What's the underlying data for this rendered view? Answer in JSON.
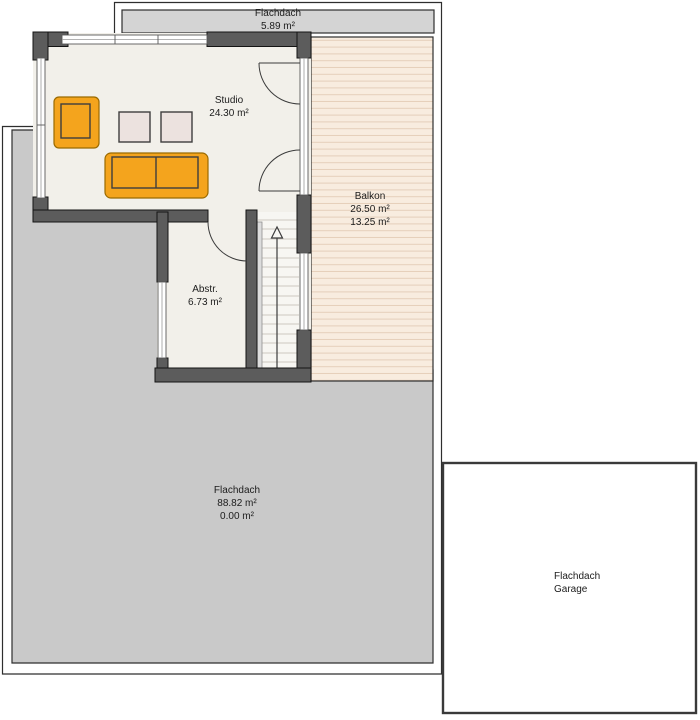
{
  "colors": {
    "pageBg": "#ffffff",
    "outline": "#2e2e2e",
    "wall": "#5c5c5c",
    "wallEdge": "#141414",
    "roofGray": "#c9c9c9",
    "roofStripGray": "#d4d4d4",
    "floor": "#f2f0ea",
    "stairsFloor": "#f7f6f2",
    "balkonBg": "#f8ecdf",
    "balkonLine": "#e5cfba",
    "windowLine": "#5a5a5a",
    "doorArc": "#3c3c3c",
    "stepLine": "#ccc8c0",
    "sofaOrange": "#f4a41d",
    "sofaEdge": "#9a6a00",
    "cushionEdge": "#3e3e3e",
    "tableFill": "#ece2df",
    "tableEdge": "#3e3e3e",
    "garageBorder": "#3a3a3a",
    "text": "#1c1c1c"
  },
  "labels": {
    "roof_top": {
      "name": "Flachdach",
      "area": "5.89 m²"
    },
    "studio": {
      "name": "Studio",
      "area": "24.30 m²"
    },
    "balkon": {
      "name": "Balkon",
      "area_total": "26.50 m²",
      "area_living": "13.25 m²"
    },
    "abstellraum": {
      "name": "Abstr.",
      "area": "6.73 m²"
    },
    "roof_main": {
      "name": "Flachdach",
      "area_total": "88.82 m²",
      "area_living": "0.00 m²"
    },
    "garage": {
      "name": "Flachdach",
      "type": "Garage"
    }
  },
  "icons": {
    "stairs_direction": "up-arrow"
  }
}
